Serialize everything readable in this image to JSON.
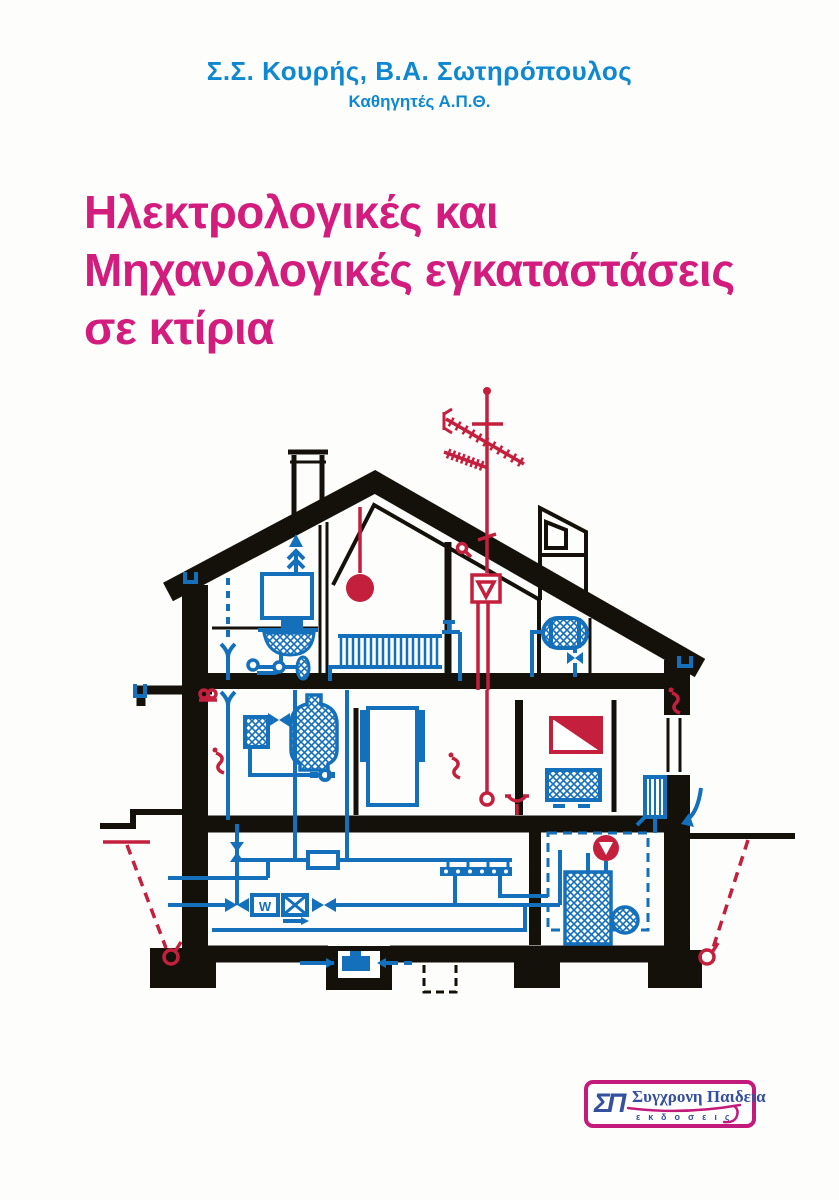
{
  "cover": {
    "authors": "Σ.Σ. Κουρής,  Β.Α. Σωτηρόπουλος",
    "authors_subtitle": "Καθηγητές Α.Π.Θ.",
    "title_lines": [
      "Ηλεκτρολογικές και",
      "Μηχανολογικές εγκαταστάσεις",
      "σε κτίρια"
    ]
  },
  "publisher": {
    "monogram": "ΣΠ",
    "name": "Συγχρονη Παιδεια",
    "subtitle": "εκδοσεις"
  },
  "colors": {
    "structure": "#14110b",
    "plumbing": "#1470ba",
    "electrical": "#c41f3c",
    "title": "#d21d7e",
    "author": "#0e88d0",
    "brand": "#c21b7c",
    "logo": "#35509e"
  },
  "diagram": {
    "type": "house-cross-section",
    "water_meter_label": "W",
    "legend": {
      "black": "building structure",
      "blue": "plumbing / heating / water installations",
      "red": "electrical / antenna / grounding installations"
    },
    "components": [
      "tv-antenna",
      "antenna-amplifier",
      "antenna-cable",
      "tv-outlet",
      "pendant-lamp",
      "light-switches",
      "distribution-board",
      "wall-socket",
      "grounding-electrodes",
      "roof",
      "chimney",
      "dormer-chimney",
      "water-tank",
      "vent-pipe",
      "washbasin-with-trap",
      "radiators",
      "hot-water-cylinder",
      "toilet-cistern",
      "water-heater",
      "door-frame",
      "electric-appliance",
      "water-meter",
      "filter",
      "shut-off-valves",
      "distribution-manifold",
      "boiler",
      "burner",
      "circulation-pump",
      "sump-pump",
      "floor-drains",
      "gutters",
      "water-supply-lines",
      "foundation-footings",
      "canopy"
    ]
  }
}
